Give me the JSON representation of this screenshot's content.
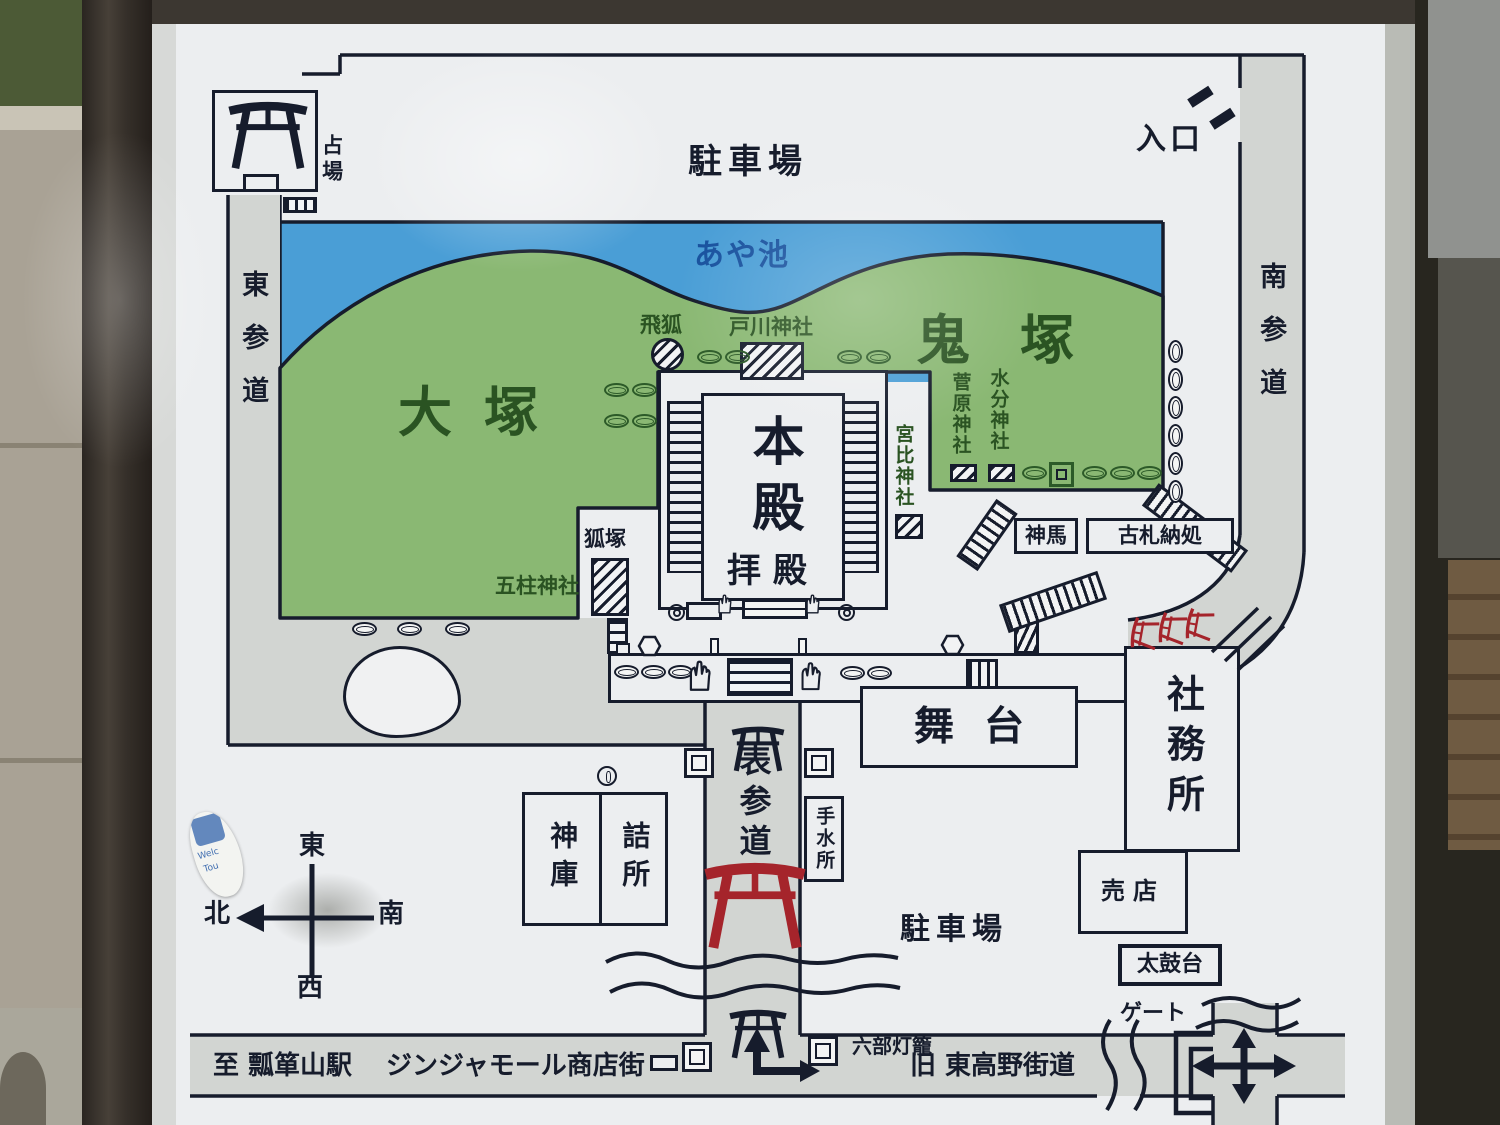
{
  "sign": {
    "labels": {
      "parking_top": "駐車場",
      "entrance": "入口",
      "uranaiba": "占場",
      "higashi_sando": "東参道",
      "minami_sando": "南参道",
      "aya_pond": "あや池",
      "otsuka": "大塚",
      "onizuka": "鬼塚",
      "tobigitsune": "飛狐",
      "togawa_shrine": "戸川神社",
      "sugawara_shrine": "菅原神社",
      "mikumari_shrine": "水分神社",
      "miyabi_shrine": "宮比神社",
      "kitsunezuka": "狐塚",
      "gochuu_shrine": "五柱神社",
      "honden": "本殿",
      "haiden": "拝殿",
      "shinme": "神馬",
      "kosatsu": "古札納処",
      "butai": "舞台",
      "shamusho": "社務所",
      "baiten": "売店",
      "taikodai": "太鼓台",
      "shinko": "神庫",
      "tsumesho": "詰所",
      "omote_sando": "表参道",
      "chouzusho": "手水所",
      "parking_bottom": "駐車場",
      "rokubu_toro": "六部灯籠",
      "gate": "ゲート",
      "to_station": "至 瓢箪山駅",
      "jinja_mall": "ジンジャモール商店街",
      "old_road": "旧 東高野街道",
      "compass_e": "東",
      "compass_w": "西",
      "compass_n": "北",
      "compass_s": "南",
      "sticker_line1": "Welc",
      "sticker_line2": "Tou"
    },
    "colors": {
      "pond": "#4a9ed6",
      "hill": "#8ab873",
      "road": "#d2d5d2",
      "line": "#161c2c",
      "sign_background": "#eceef0",
      "torii_red": "#a5242b",
      "hill_text": "#2a5322",
      "pond_text": "#17519e"
    },
    "icons": [
      "torii-icon",
      "stone-icon",
      "lantern-icon",
      "stairs-icon",
      "shrine-hatch-icon",
      "statue-hand-icon",
      "hexagon-stone-icon",
      "circle-marker-icon",
      "compass-rose-icon",
      "entrance-dash-icon",
      "direction-arrow-icon",
      "stream-icon",
      "gate-bracket-icon"
    ]
  }
}
